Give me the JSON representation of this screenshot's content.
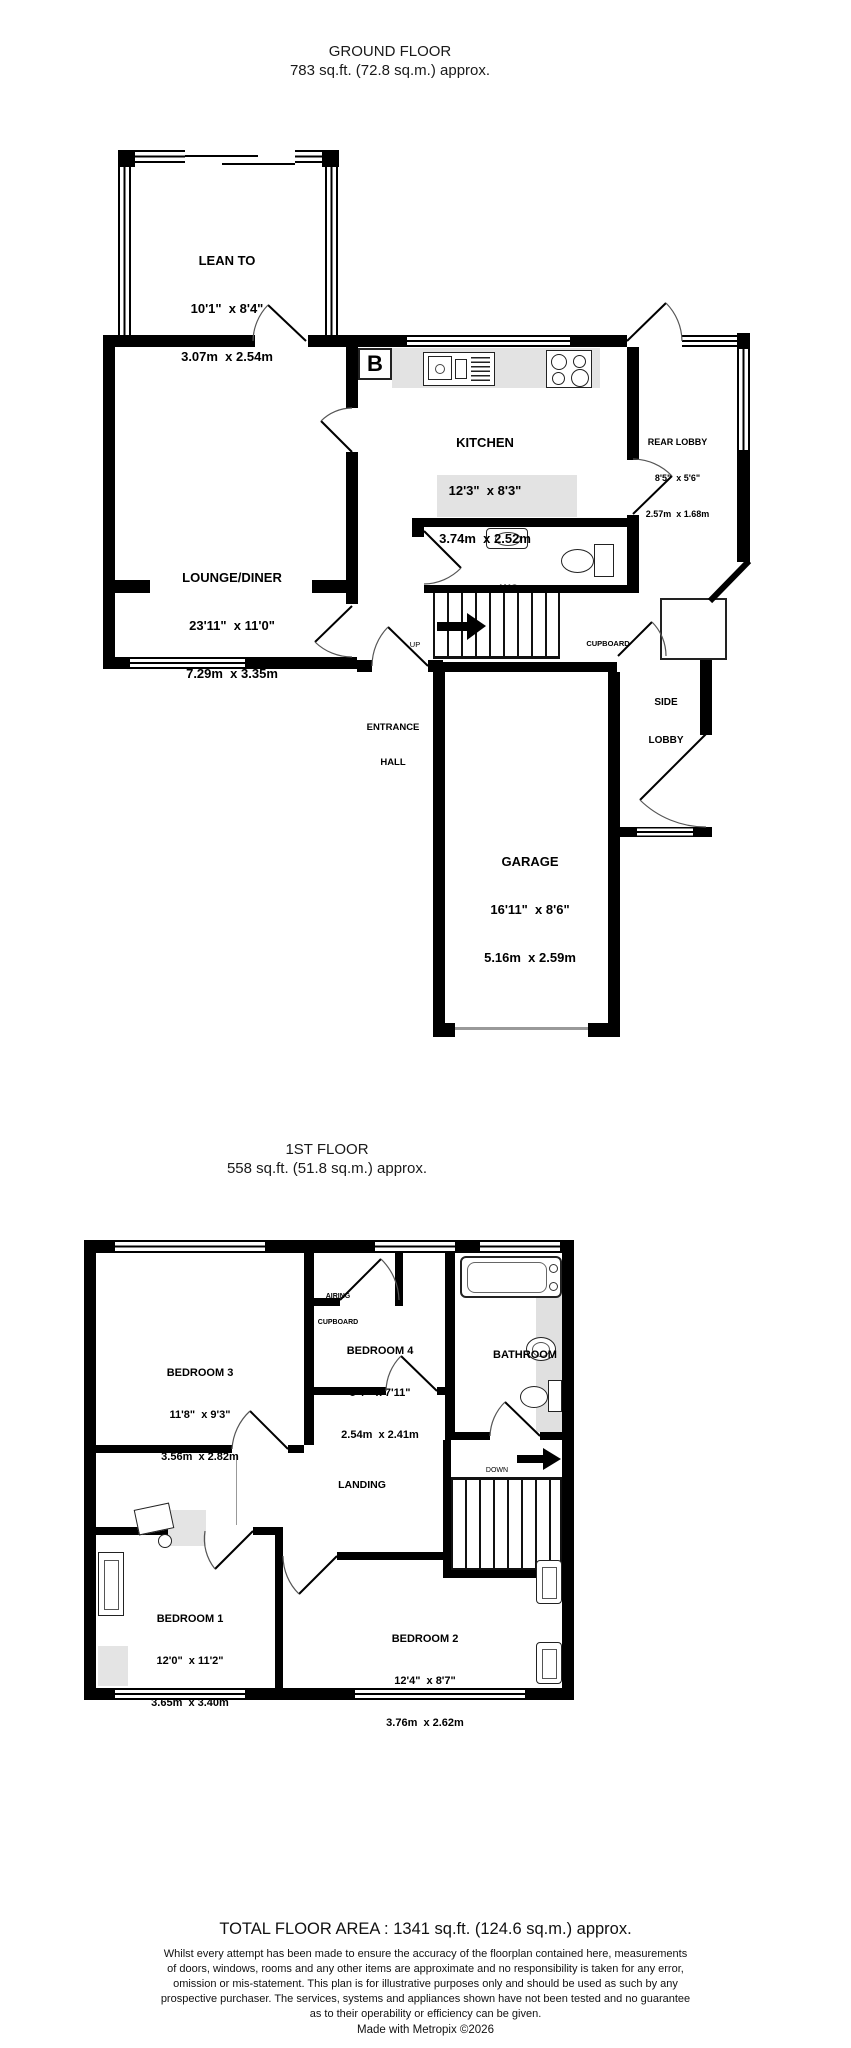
{
  "colors": {
    "wall": "#000000",
    "counter": "#e3e3e3",
    "tile": "#e0e0e0",
    "rug": "#e4e4e4",
    "background": "#ffffff"
  },
  "ground_floor": {
    "title": "GROUND FLOOR",
    "subtitle": "783 sq.ft. (72.8 sq.m.) approx.",
    "boiler_label": "B",
    "up_label": "UP",
    "rooms": {
      "lean_to": {
        "name": "LEAN TO",
        "imperial": "10'1\"  x 8'4\"",
        "metric": "3.07m  x 2.54m"
      },
      "lounge": {
        "name": "LOUNGE/DINER",
        "imperial": "23'11\"  x 11'0\"",
        "metric": "7.29m  x 3.35m"
      },
      "kitchen": {
        "name": "KITCHEN",
        "imperial": "12'3\"  x 8'3\"",
        "metric": "3.74m  x 2.52m"
      },
      "rear_lobby": {
        "name": "REAR LOBBY",
        "imperial": "8'5\"  x 5'6\"",
        "metric": "2.57m  x 1.68m"
      },
      "wc": {
        "name": "WC"
      },
      "cupboard": {
        "name": "CUPBOARD"
      },
      "side_lobby": {
        "line1": "SIDE",
        "line2": "LOBBY"
      },
      "entrance_hall": {
        "line1": "ENTRANCE",
        "line2": "HALL"
      },
      "garage": {
        "name": "GARAGE",
        "imperial": "16'11\"  x 8'6\"",
        "metric": "5.16m  x 2.59m"
      }
    },
    "fixtures": [
      "boiler",
      "sink-drainer",
      "hob",
      "worktop",
      "wc-basin",
      "toilet",
      "stairs-up"
    ]
  },
  "first_floor": {
    "title": "1ST FLOOR",
    "subtitle": "558 sq.ft. (51.8 sq.m.) approx.",
    "down_label": "DOWN",
    "rooms": {
      "bedroom3": {
        "name": "BEDROOM 3",
        "imperial": "11'8\"  x 9'3\"",
        "metric": "3.56m  x 2.82m"
      },
      "bedroom4": {
        "name": "BEDROOM 4",
        "imperial": "8'4\"  x 7'11\"",
        "metric": "2.54m  x 2.41m"
      },
      "bathroom": {
        "name": "BATHROOM"
      },
      "landing": {
        "name": "LANDING"
      },
      "airing_cupboard": {
        "line1": "AIRING",
        "line2": "CUPBOARD"
      },
      "bedroom1": {
        "name": "BEDROOM 1",
        "imperial": "12'0\"  x 11'2\"",
        "metric": "3.65m  x 3.40m"
      },
      "bedroom2": {
        "name": "BEDROOM 2",
        "imperial": "12'4\"  x 8'7\"",
        "metric": "3.76m  x 2.62m"
      }
    },
    "fixtures": [
      "bath",
      "basin",
      "toilet",
      "stairs-down",
      "wardrobe",
      "chairs",
      "desk"
    ]
  },
  "footer": {
    "total": "TOTAL FLOOR AREA : 1341 sq.ft. (124.6 sq.m.) approx.",
    "disclaimer_lines": [
      "Whilst every attempt has been made to ensure the accuracy of the floorplan contained here, measurements",
      "of doors, windows, rooms and any other items are approximate and no responsibility is taken for any error,",
      "omission or mis-statement. This plan is for illustrative purposes only and should be used as such by any",
      "prospective purchaser. The services, systems and appliances shown have not been tested and no guarantee",
      "as to their operability or efficiency can be given."
    ],
    "credit": "Made with Metropix ©2026"
  }
}
